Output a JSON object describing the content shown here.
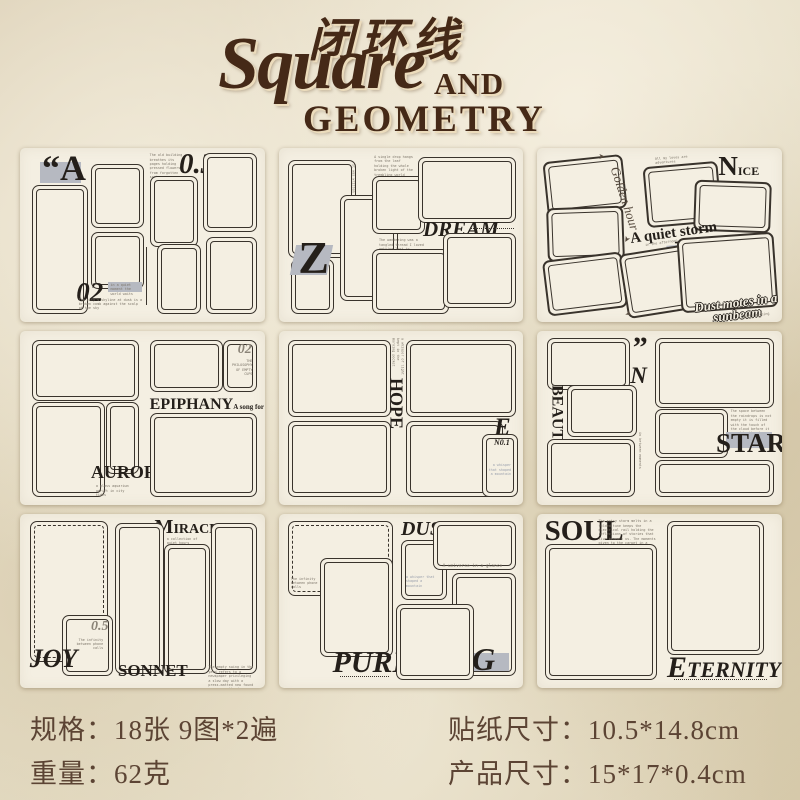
{
  "header": {
    "title_cn": "闭环线",
    "title_script": "Square",
    "title_and": "AND",
    "title_geometry": "GEOMETRY"
  },
  "colors": {
    "title_brown": "#452917",
    "sheet_cream": "#f4efe2",
    "ink": "#2e2823",
    "chip_gray": "#b6b9c1",
    "spec_brown": "#5c4434"
  },
  "specs": {
    "left": [
      {
        "label": "规格：",
        "value": "18张 9图*2遍"
      },
      {
        "label": "重量：",
        "value": "62克"
      }
    ],
    "right": [
      {
        "label": "贴纸尺寸：",
        "value": "10.5*14.8cm"
      },
      {
        "label": "产品尺寸：",
        "value": "15*17*0.4cm"
      }
    ]
  },
  "sheets": {
    "s1": {
      "quote_letter": "“A",
      "num_top": "0.3",
      "num_bottom": "02",
      "tiny_top": "The old building breathes its pages holding pressed flowers from forgotten springs",
      "tiny_bottom": "The city's skyline at dusk is a broken comb against the scalp of the sky",
      "tiny_chip": "in a quiet moment the world waits"
    },
    "s2": {
      "letter_z": "Z",
      "dream": "DREAM",
      "lucid": "Lucid",
      "lucid_sub": "Dreams",
      "tiny_top": "A single drop hangs from the leaf holding the whole broken light of the trembling world",
      "tiny_mid": "The wandering was a tangled thread I loved getting lost in",
      "tiny_feeling": "The feeling of something about to happen",
      "tiny_side": "it was written by the moment"
    },
    "s3": {
      "golden": "Golden hour",
      "nice_initial": "N",
      "nice_rest": "ICE",
      "tiny_top": "All my loves are adventures",
      "storm": "A quiet storm",
      "afternoon": "in the afternoon",
      "letter_b": "B",
      "dust": "Dust motes in a",
      "dust2": "sunbeam",
      "dust_sub": "dusty morning"
    },
    "s4": {
      "aurora": "AURORA",
      "aurora_sub": "a glass aquarium adrift in city tides",
      "epiphany": "EPIPHANY",
      "epiphany_sub": "A song for no audience",
      "num": "02",
      "num_sub": "THE PHILOSOPHY OF EMPTY CUPS"
    },
    "s5": {
      "hope": "HOPE",
      "letter_e": "E",
      "no1": "N0.1",
      "tiny": "a whisper that shaped a mountain",
      "tiny_side": "a whisper of light kept in the morning pocket"
    },
    "s6": {
      "beauty": "BEAUTY",
      "quote": "”",
      "letter_n": "N",
      "star": "STAR",
      "tiny_side": "in between moments",
      "tiny_para": "The space between the raindrops is not empty it is filled with the touch of the cloud before it waved to the sky"
    },
    "s7": {
      "joy": "JOY",
      "num": "0.5",
      "num_sub": "The infinity between phone calls",
      "miracle_initial": "M",
      "miracle_rest": "IRACLE ”",
      "miracle_sub": "a collection of quiet hours",
      "sonnet": "SONNET",
      "tiny_bottom": "The empty swing in the yard refers to a newspaper privileging a slow day with a press-matted new found ways over the day"
    },
    "s8": {
      "dusk": "DUSK",
      "pure": "PURE",
      "letter_g": "G",
      "universe": "A universe in a glance",
      "tiny_left": "The infinity between phone calls",
      "tiny_mid": "a whisper that shaped a mountain"
    },
    "s9": {
      "soul": "SOUL",
      "eternity_initial": "E",
      "eternity_rest": "TERNITY",
      "tiny_para": "The entry storm melts in a folded tune keeps the electrical rail holding the reflections of stories that live beneath us. The moments given to the carpet in a haven of sleeping moments lead one another for a shelf to hold in minds."
    }
  }
}
